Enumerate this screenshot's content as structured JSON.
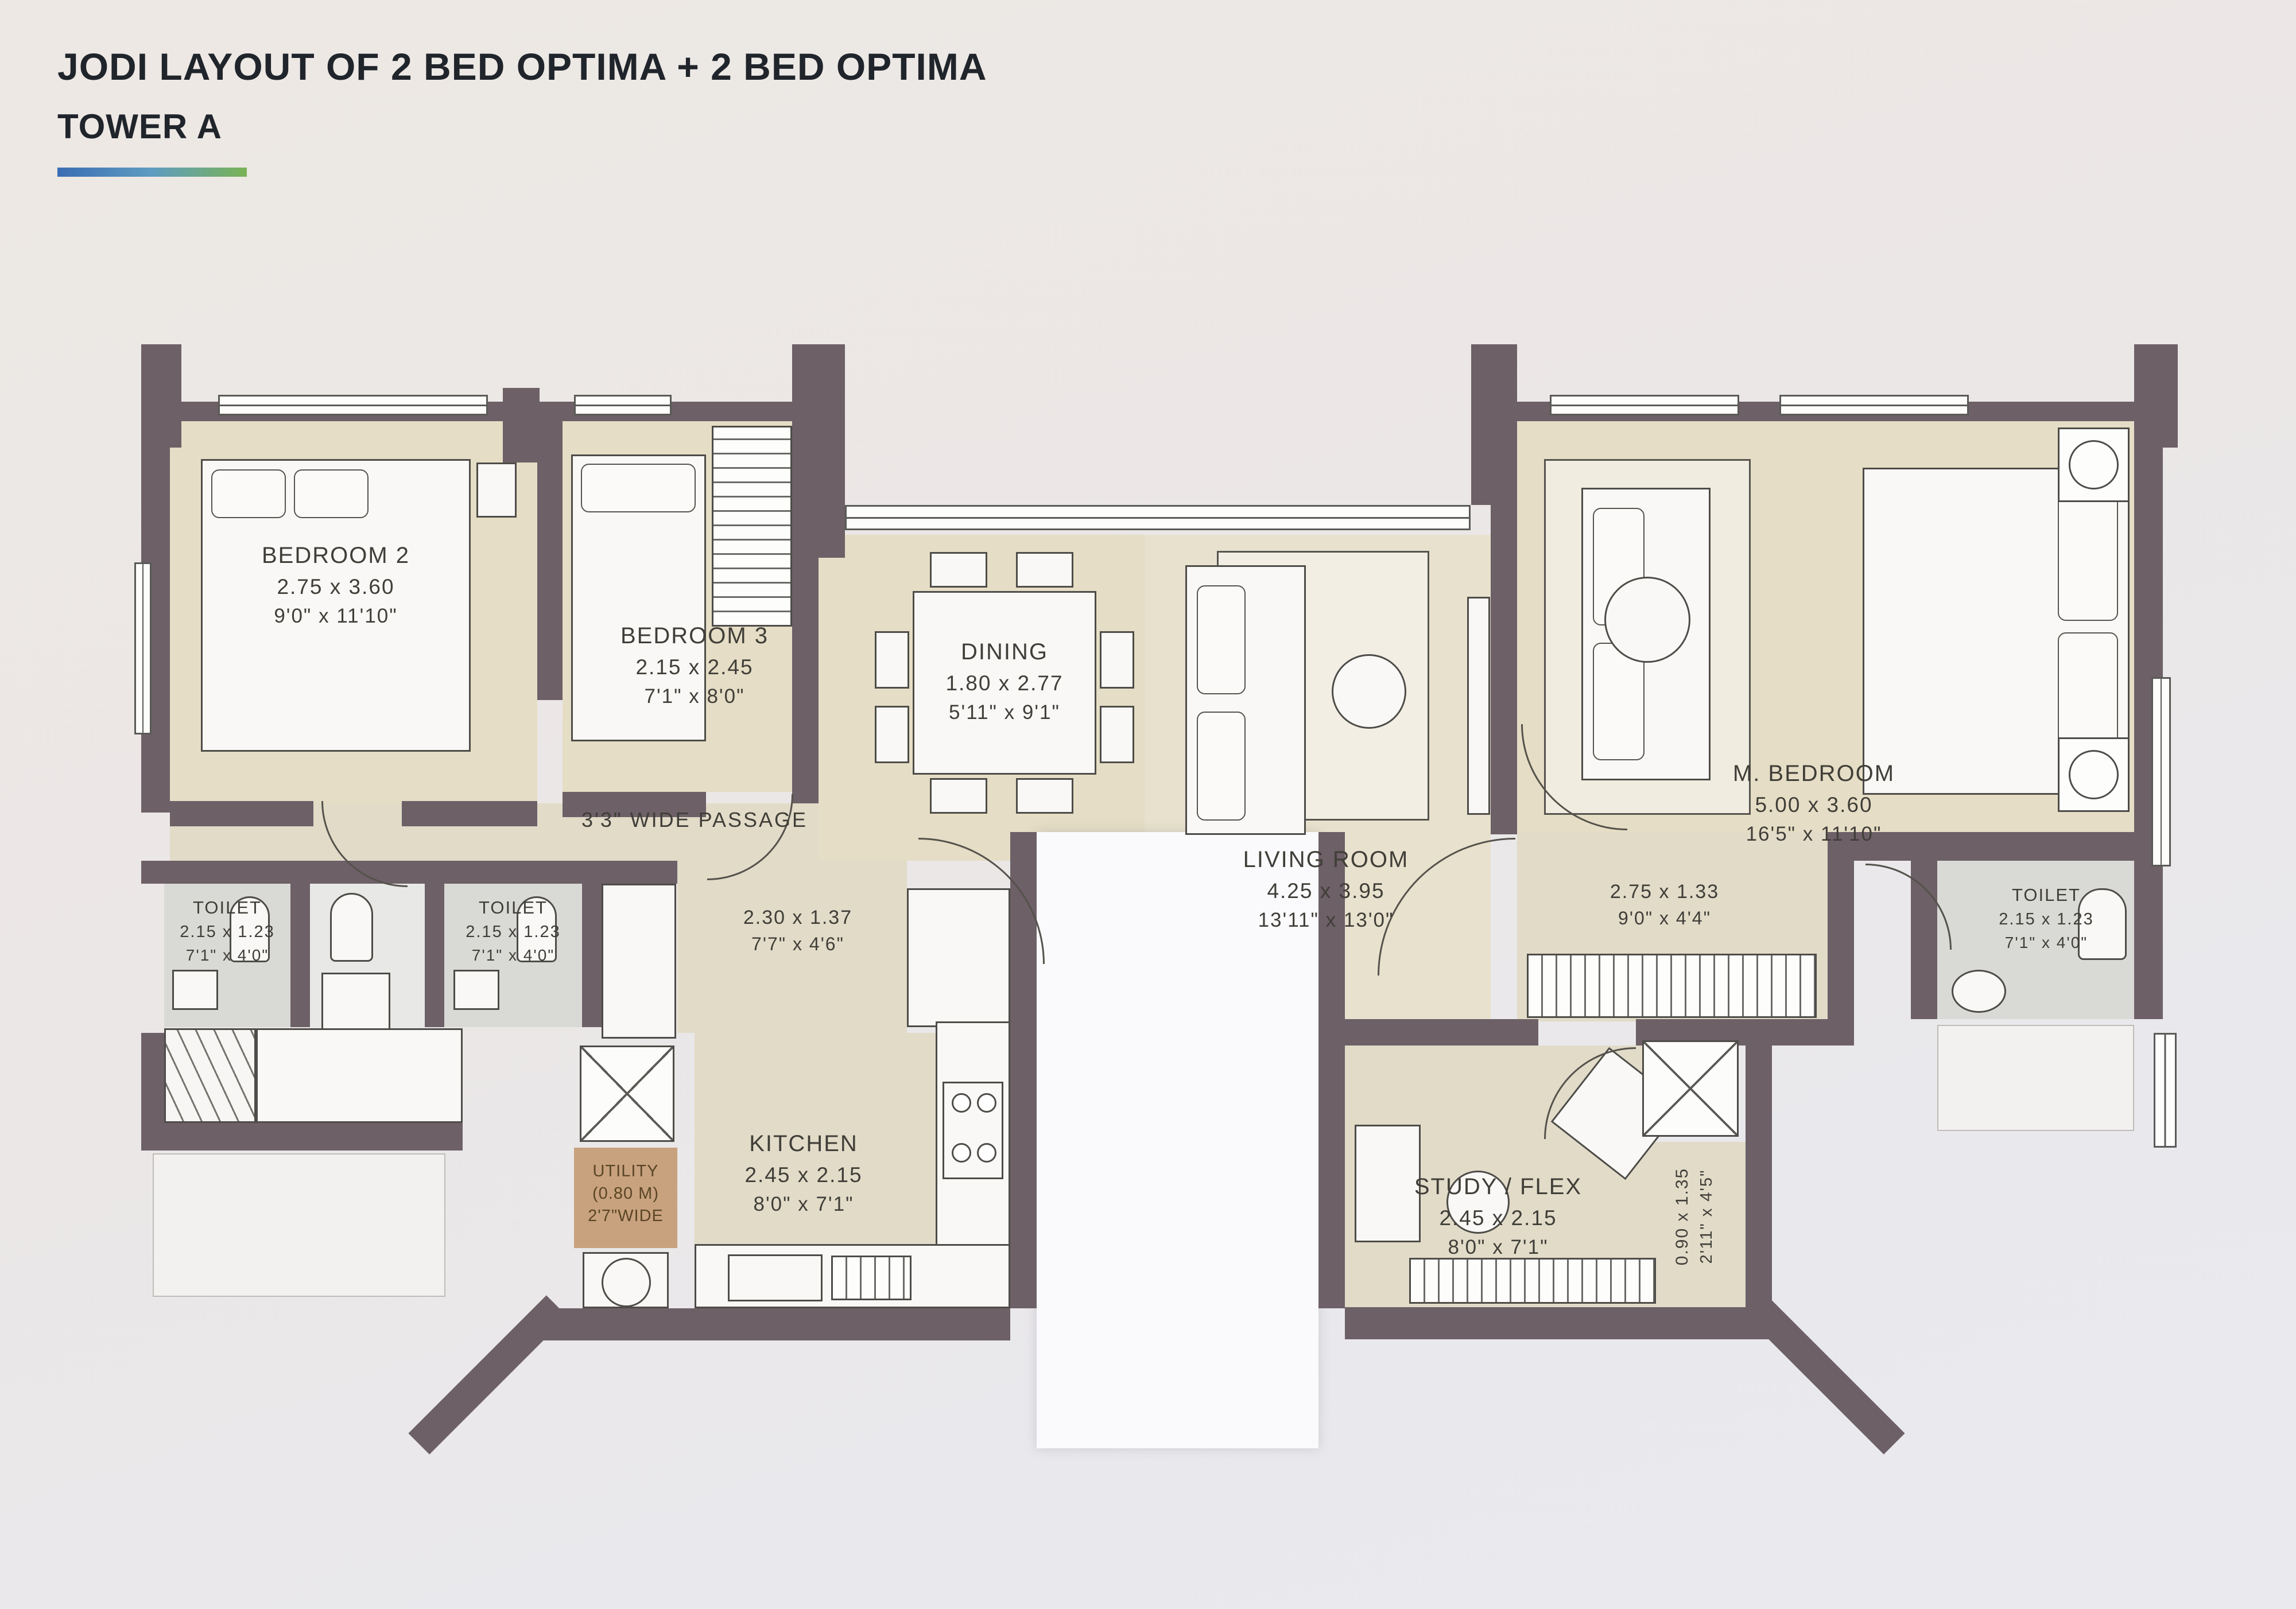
{
  "header": {
    "title": "JODI LAYOUT OF 2 BED OPTIMA + 2 BED OPTIMA",
    "subtitle": "TOWER A"
  },
  "palette": {
    "wall": "#6d6067",
    "floor_beige": "#e5ddc5",
    "accent_blue": "#3a6db3",
    "accent_green": "#79b356"
  },
  "rooms": {
    "bedroom2": {
      "name": "BEDROOM 2",
      "metric": "2.75 x 3.60",
      "imperial": "9'0\" x 11'10\""
    },
    "bedroom3": {
      "name": "BEDROOM 3",
      "metric": "2.15 x 2.45",
      "imperial": "7'1\" x 8'0\""
    },
    "dining": {
      "name": "DINING",
      "metric": "1.80 x 2.77",
      "imperial": "5'11\" x 9'1\""
    },
    "living": {
      "name": "LIVING ROOM",
      "metric": "4.25 x 3.95",
      "imperial": "13'11\" x 13'0\""
    },
    "master": {
      "name": "M. BEDROOM",
      "metric": "5.00 x 3.60",
      "imperial": "16'5\" x 11'10\""
    },
    "toilet_left1": {
      "name": "TOILET",
      "metric": "2.15 x 1.23",
      "imperial": "7'1\" x 4'0\""
    },
    "toilet_left2": {
      "name": "TOILET",
      "metric": "2.15 x 1.23",
      "imperial": "7'1\" x 4'0\""
    },
    "toilet_right": {
      "name": "TOILET",
      "metric": "2.15 x 1.23",
      "imperial": "7'1\" x 4'0\""
    },
    "kitchen": {
      "name": "KITCHEN",
      "metric": "2.45 x 2.15",
      "imperial": "8'0\" x 7'1\""
    },
    "study": {
      "name": "STUDY / FLEX",
      "metric": "2.45 x 2.15",
      "imperial": "8'0\" x 7'1\""
    },
    "hall": {
      "metric": "2.30 x 1.37",
      "imperial": "7'7\" x 4'6\""
    },
    "dressing": {
      "metric": "2.75 x 1.33",
      "imperial": "9'0\" x 4'4\""
    },
    "niche": {
      "metric": "0.90 x 1.35",
      "imperial": "2'11\" x 4'5\""
    },
    "utility": {
      "line1": "UTILITY",
      "line2": "(0.80 M)",
      "line3": "2'7\"WIDE"
    },
    "passage": {
      "label": "3'3\" WIDE PASSAGE"
    }
  }
}
